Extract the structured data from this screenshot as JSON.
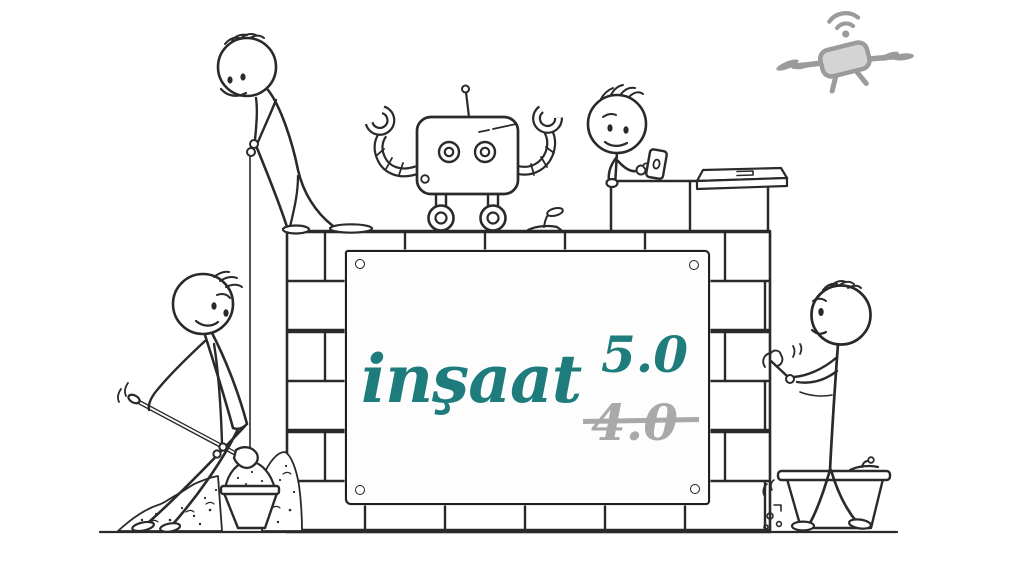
{
  "sign": {
    "title": "inşaat",
    "new_version": "5.0",
    "old_version": "4.0"
  },
  "colors": {
    "title_teal": "#1e7c7c",
    "old_gray": "#a9a9a9",
    "ink": "#2a2a2a",
    "drone_gray": "#9b9b9b"
  },
  "scene": {
    "elements": [
      "brick-wall",
      "banner-sign",
      "bricklayer-with-plumb-line",
      "robot",
      "worker-with-smartphone",
      "drone",
      "worker-shoveling-sand",
      "sand-pile",
      "bucket",
      "shovel",
      "mason-with-trowel",
      "mortar-tub",
      "trowel",
      "ground-line"
    ]
  }
}
